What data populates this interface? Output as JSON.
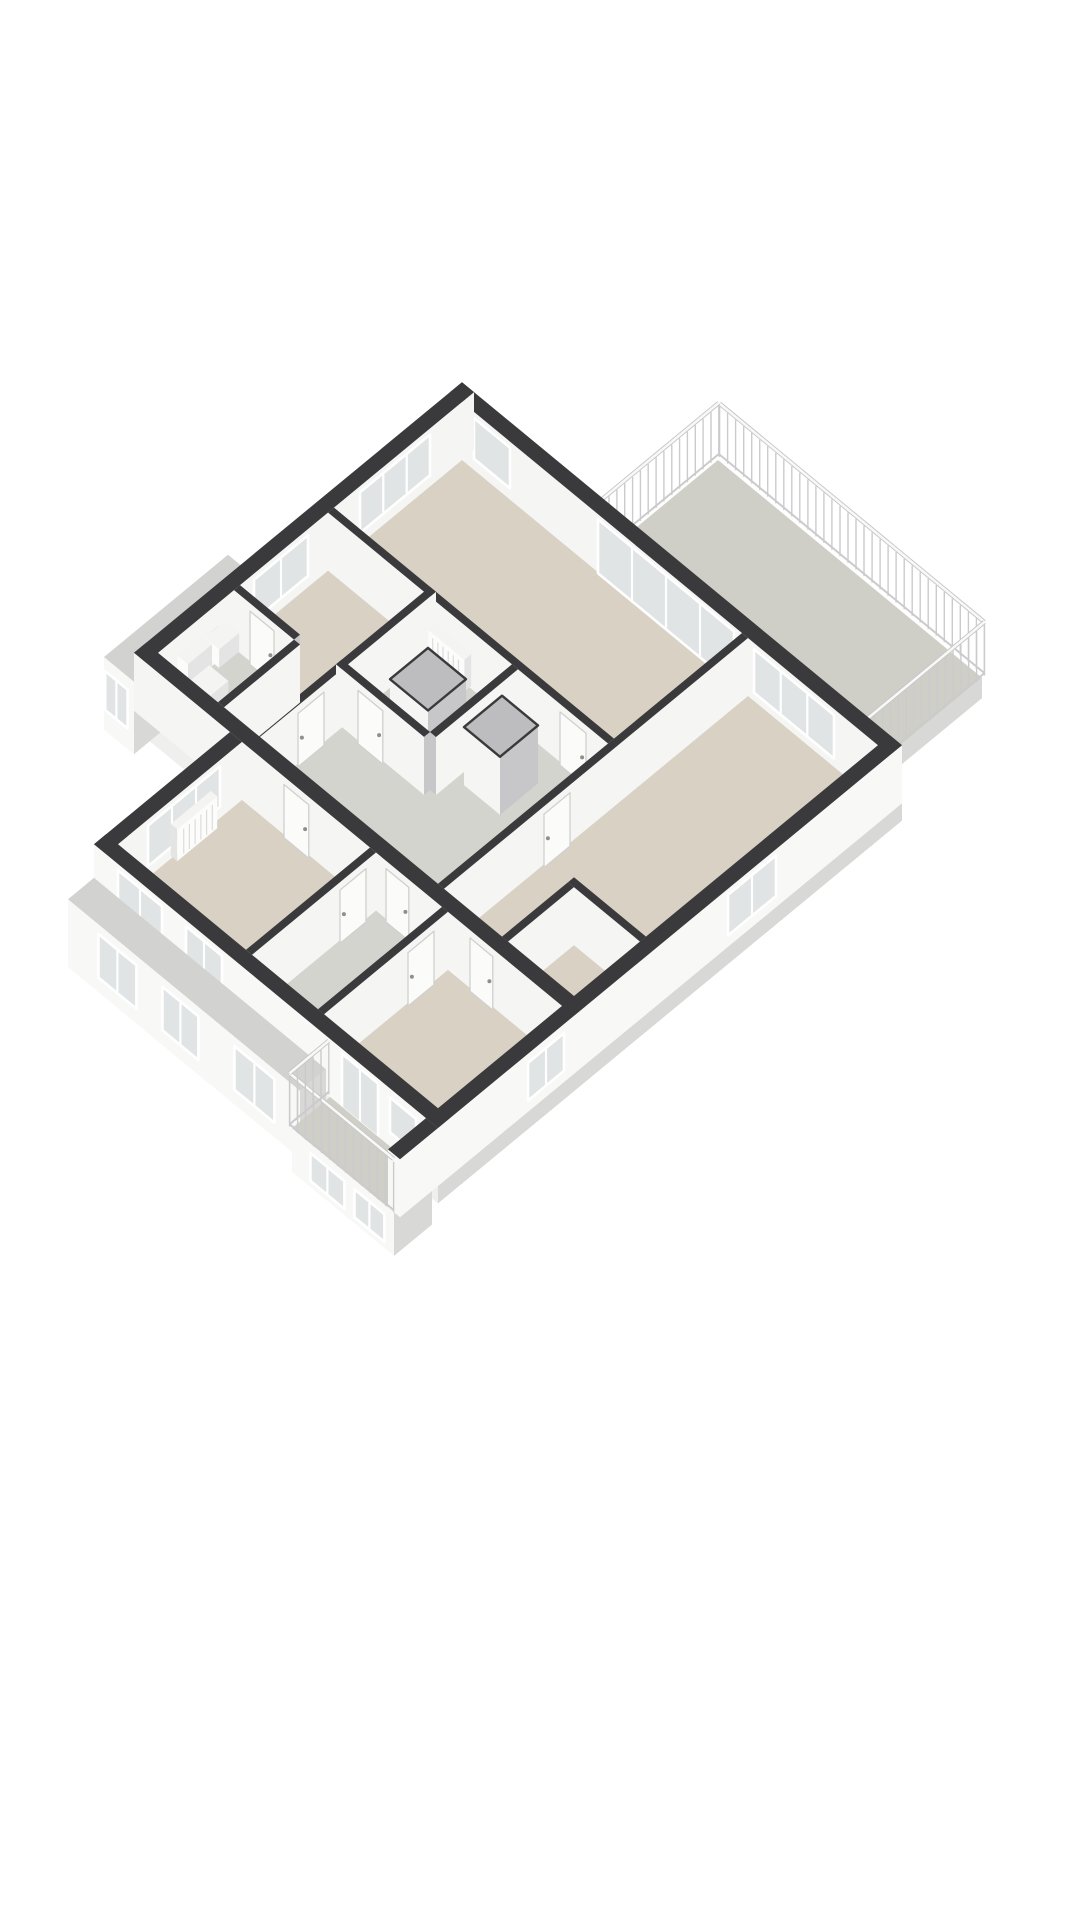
{
  "canvas": {
    "width": 1080,
    "height": 1920
  },
  "figure": {
    "kind": "isometric-3d-floorplan-render"
  },
  "palette": {
    "background": "#ffffff",
    "capDark": "#3a3a3c",
    "extX": "#ececee",
    "extY": "#f8f8f7",
    "intX": "#c7c7c9",
    "intY": "#f5f5f4",
    "slabTop": "#e6e6e4",
    "slabSide": "#d8d8d6",
    "slabFace": "#efefed",
    "bayTop": "#d2d2d0",
    "terraceFloor": "#cfcfc7",
    "floorBeige": "#d9d2c4",
    "floorGray": "#d4d4cf",
    "glass": "#e0e4e4",
    "frame": "#ffffff",
    "doorFill": "#fbfbfa",
    "doorEdge": "#d0d0d0",
    "railPost": "#cbcbcd",
    "ductTop": "#bdbdbf",
    "fixTop": "#f4f4f3",
    "fixSide": "#e4e4e5",
    "fixFace": "#fcfcfb"
  },
  "projection": {
    "cx": 462,
    "cy": 460,
    "ux": 40,
    "uy": 33,
    "uz": 58
  },
  "scene": [
    {
      "t": "box",
      "n": "terrace-slab",
      "x1": 3.2,
      "y1": -3.2,
      "x2": 9.8,
      "y2": -0.3,
      "z0": -0.35,
      "z1": 0,
      "top": "terraceFloor",
      "fx": "slabSide",
      "fy": "slabFace"
    },
    {
      "t": "rail",
      "n": "terrace-railing-back",
      "x1": 3.2,
      "y1": -3.24,
      "x2": 9.82,
      "y2": -3.24,
      "h": 0.95
    },
    {
      "t": "rail",
      "n": "terrace-railing-left",
      "x1": 3.18,
      "y1": -3.24,
      "x2": 3.18,
      "y2": -0.3,
      "h": 0.95
    },
    {
      "t": "rail",
      "n": "terrace-railing-right",
      "x1": 9.82,
      "y1": -3.24,
      "x2": 9.82,
      "y2": -0.3,
      "h": 0.95
    },
    {
      "t": "box",
      "n": "apartment-slab",
      "x1": -0.3,
      "y1": -0.3,
      "x2": 10.7,
      "y2": 7.9,
      "z0": -0.3,
      "z1": 0,
      "top": "slabTop",
      "fx": "slabSide",
      "fy": "slabFace"
    },
    {
      "t": "box",
      "n": "lower-slab",
      "x1": 2.1,
      "y1": 7.9,
      "x2": 10.7,
      "y2": 11.3,
      "z0": -0.3,
      "z1": 0,
      "top": "slabTop",
      "fx": "slabSide",
      "fy": "slabFace"
    },
    {
      "t": "box",
      "n": "side-bay",
      "x1": -1.05,
      "y1": 4.8,
      "x2": -0.3,
      "y2": 7.9,
      "z0": -0.75,
      "z1": 0.5,
      "top": "bayTop",
      "fx": "slabSide",
      "fy": "extY"
    },
    {
      "t": "panel",
      "n": "bay-window",
      "plane": "y",
      "c": 7.9,
      "off": 0.04,
      "u1": -0.98,
      "u2": -0.42,
      "z1": -0.35,
      "z2": 0.32,
      "fill": "glass",
      "mull": 2
    },
    {
      "t": "floor",
      "n": "living-room-floor",
      "pts": [
        [
          0,
          0
        ],
        [
          7.0,
          0
        ],
        [
          7.0,
          3.2
        ],
        [
          0,
          3.2
        ]
      ],
      "fill": "floorBeige"
    },
    {
      "t": "floor",
      "n": "master-bedroom-floor",
      "pts": [
        [
          7.15,
          0
        ],
        [
          10.4,
          0
        ],
        [
          10.4,
          7.6
        ],
        [
          7.15,
          7.6
        ]
      ],
      "fill": "floorBeige"
    },
    {
      "t": "floor",
      "n": "left-room-floor",
      "pts": [
        [
          0,
          3.35
        ],
        [
          2.4,
          3.35
        ],
        [
          2.4,
          7.6
        ],
        [
          0,
          7.6
        ]
      ],
      "fill": "floorBeige"
    },
    {
      "t": "floor",
      "n": "wc-floor",
      "pts": [
        [
          0,
          5.7
        ],
        [
          1.5,
          5.7
        ],
        [
          1.5,
          7.6
        ],
        [
          0,
          7.6
        ]
      ],
      "fill": "floorGray"
    },
    {
      "t": "floor",
      "n": "hall-floor",
      "pts": [
        [
          2.55,
          3.35
        ],
        [
          7.0,
          3.35
        ],
        [
          7.0,
          7.6
        ],
        [
          2.55,
          7.6
        ]
      ],
      "fill": "floorGray"
    },
    {
      "t": "floor",
      "n": "bathroom-floor",
      "pts": [
        [
          2.55,
          3.35
        ],
        [
          4.6,
          3.35
        ],
        [
          4.6,
          5.4
        ],
        [
          2.55,
          5.4
        ]
      ],
      "fill": "floorGray"
    },
    {
      "t": "floor",
      "n": "bedroom2-floor",
      "pts": [
        [
          2.4,
          7.9
        ],
        [
          5.6,
          7.9
        ],
        [
          5.6,
          11.0
        ],
        [
          2.4,
          11.0
        ]
      ],
      "fill": "floorBeige"
    },
    {
      "t": "floor",
      "n": "bathroom2-floor",
      "pts": [
        [
          5.75,
          7.9
        ],
        [
          7.4,
          7.9
        ],
        [
          7.4,
          11.0
        ],
        [
          5.75,
          11.0
        ]
      ],
      "fill": "floorGray"
    },
    {
      "t": "floor",
      "n": "bedroom3-floor",
      "pts": [
        [
          7.55,
          7.9
        ],
        [
          10.4,
          7.9
        ],
        [
          10.4,
          11.0
        ],
        [
          7.55,
          11.0
        ]
      ],
      "fill": "floorBeige"
    },
    {
      "t": "box",
      "n": "north-wall",
      "x1": -0.3,
      "y1": -0.3,
      "x2": 10.7,
      "y2": 0,
      "z0": 0,
      "z1": 1,
      "top": "capDark",
      "fx": "extX",
      "fy": "intY"
    },
    {
      "t": "panel",
      "n": "corner-window",
      "plane": "y",
      "c": 0,
      "off": 0.05,
      "u1": 0.35,
      "u2": 1.25,
      "z1": 0.25,
      "z2": 0.95,
      "fill": "glass"
    },
    {
      "t": "panel",
      "n": "terrace-glass-doors",
      "plane": "y",
      "c": 0,
      "off": 0.05,
      "u1": 3.45,
      "u2": 6.85,
      "z1": 0.04,
      "z2": 0.97,
      "fill": "glass",
      "mull": 4
    },
    {
      "t": "panel",
      "n": "master-window-band",
      "plane": "y",
      "c": 0,
      "off": 0.05,
      "u1": 7.35,
      "u2": 9.35,
      "z1": 0.2,
      "z2": 0.95,
      "fill": "glass",
      "mull": 3
    },
    {
      "t": "box",
      "n": "west-wall",
      "x1": -0.3,
      "y1": -0.3,
      "x2": 0,
      "y2": 7.9,
      "z0": 0,
      "z1": 1,
      "top": "capDark",
      "fx": "intY",
      "fy": "extY"
    },
    {
      "t": "panel",
      "n": "living-window",
      "plane": "x",
      "c": 0,
      "off": 0.05,
      "u1": 0.85,
      "u2": 2.6,
      "z1": 0.25,
      "z2": 0.95,
      "fill": "glass",
      "mull": 3
    },
    {
      "t": "panel",
      "n": "left-room-window",
      "plane": "x",
      "c": 0,
      "off": 0.05,
      "u1": 3.9,
      "u2": 5.25,
      "z1": 0.25,
      "z2": 0.95,
      "fill": "glass",
      "mull": 2
    },
    {
      "t": "panel",
      "n": "wall-socket",
      "plane": "x",
      "c": 0,
      "off": 0.05,
      "u1": 6.15,
      "u2": 6.32,
      "z1": 0.5,
      "z2": 0.66,
      "fill": "#d9d9d8",
      "frame": false
    },
    {
      "t": "box",
      "n": "living-hall-wall",
      "x1": 0,
      "y1": 3.2,
      "x2": 7.0,
      "y2": 3.35,
      "z0": 0,
      "z1": 1,
      "top": "capDark",
      "fx": "intX",
      "fy": "intY"
    },
    {
      "t": "door",
      "n": "hall-door-1",
      "plane": "y",
      "c": 3.35,
      "off": 0.05,
      "u1": 5.85,
      "u2": 6.5,
      "z1": 0,
      "z2": 0.92
    },
    {
      "t": "box",
      "n": "left-room-wall",
      "x1": 2.4,
      "y1": 3.2,
      "x2": 2.55,
      "y2": 7.6,
      "z0": 0,
      "z1": 1,
      "top": "capDark",
      "fx": "intY",
      "fy": "intX"
    },
    {
      "t": "door",
      "n": "left-room-door",
      "plane": "x",
      "c": 2.55,
      "off": 0.05,
      "u1": 6.05,
      "u2": 6.7,
      "z1": 0,
      "z2": 0.92
    },
    {
      "t": "box",
      "n": "wc-front-wall",
      "x1": 0,
      "y1": 5.55,
      "x2": 1.5,
      "y2": 5.7,
      "z0": 0,
      "z1": 1,
      "top": "capDark",
      "fx": "intX",
      "fy": "intY"
    },
    {
      "t": "door",
      "n": "wc-door",
      "plane": "y",
      "c": 5.7,
      "off": 0.05,
      "u1": 0.45,
      "u2": 1.05,
      "z1": 0,
      "z2": 0.92
    },
    {
      "t": "box",
      "n": "sink",
      "x1": 0.02,
      "y1": 5.95,
      "x2": 0.38,
      "y2": 6.45,
      "z0": 0.3,
      "z1": 0.62,
      "top": "fixTop",
      "fx": "fixSide",
      "fy": "fixFace"
    },
    {
      "t": "box",
      "n": "radiator",
      "x1": 2.7,
      "y1": 3.37,
      "x2": 3.6,
      "y2": 3.54,
      "z0": 0.07,
      "z1": 0.62,
      "top": "fixTop",
      "fx": "fixSide",
      "fy": "fixFace",
      "slats": 6
    },
    {
      "t": "box",
      "n": "toilet-cistern",
      "x1": 0.04,
      "y1": 6.55,
      "x2": 0.3,
      "y2": 7.15,
      "z0": 0.22,
      "z1": 0.72,
      "top": "fixTop",
      "fx": "fixSide",
      "fy": "fixFace"
    },
    {
      "t": "box",
      "n": "toilet-bowl",
      "x1": 0.3,
      "y1": 6.62,
      "x2": 0.78,
      "y2": 7.08,
      "z0": 0,
      "z1": 0.4,
      "top": "fixTop",
      "fx": "fixSide",
      "fy": "fixFace"
    },
    {
      "t": "box",
      "n": "master-wall",
      "x1": 7.0,
      "y1": 0,
      "x2": 7.15,
      "y2": 7.6,
      "z0": 0,
      "z1": 1,
      "top": "capDark",
      "fx": "intY",
      "fy": "intX"
    },
    {
      "t": "door",
      "n": "master-door",
      "plane": "x",
      "c": 7.15,
      "off": 0.05,
      "u1": 4.5,
      "u2": 5.15,
      "z1": 0,
      "z2": 0.92
    },
    {
      "t": "box",
      "n": "wc-side-wall",
      "x1": 1.5,
      "y1": 5.7,
      "x2": 1.65,
      "y2": 7.6,
      "z0": 0,
      "z1": 1,
      "top": "capDark",
      "fx": "intY",
      "fy": "intX"
    },
    {
      "t": "box",
      "n": "duct-1",
      "x1": 3.3,
      "y1": 4.15,
      "x2": 4.25,
      "y2": 5.1,
      "z0": 0,
      "z1": 1,
      "top": "ductTop",
      "fx": "intX",
      "fy": "intY",
      "rim": true
    },
    {
      "t": "box",
      "n": "bath-front-wall",
      "x1": 2.4,
      "y1": 5.4,
      "x2": 4.6,
      "y2": 5.55,
      "z0": 0,
      "z1": 1,
      "top": "capDark",
      "fx": "intX",
      "fy": "intY"
    },
    {
      "t": "door",
      "n": "bath-door",
      "plane": "y",
      "c": 5.55,
      "off": 0.05,
      "u1": 3.0,
      "u2": 3.62,
      "z1": 0,
      "z2": 0.92
    },
    {
      "t": "box",
      "n": "bath-side-wall",
      "x1": 4.6,
      "y1": 3.35,
      "x2": 4.75,
      "y2": 5.4,
      "z0": 0,
      "z1": 1,
      "top": "capDark",
      "fx": "intY",
      "fy": "intX"
    },
    {
      "t": "box",
      "n": "duct-2",
      "x1": 4.95,
      "y1": 3.95,
      "x2": 5.85,
      "y2": 4.9,
      "z0": 0,
      "z1": 1,
      "top": "ductTop",
      "fx": "intX",
      "fy": "intY",
      "rim": true
    },
    {
      "t": "box",
      "n": "closet-front-wall",
      "x1": 8.6,
      "y1": 5.8,
      "x2": 10.4,
      "y2": 5.95,
      "z0": 0,
      "z1": 1,
      "top": "capDark",
      "fx": "intX",
      "fy": "intY"
    },
    {
      "t": "box",
      "n": "closet-side-wall",
      "x1": 8.6,
      "y1": 5.95,
      "x2": 8.75,
      "y2": 7.6,
      "z0": 0,
      "z1": 1,
      "top": "capDark",
      "fx": "intY",
      "fy": "intX"
    },
    {
      "t": "box",
      "n": "mid-wall",
      "x1": -0.3,
      "y1": 7.6,
      "x2": 10.7,
      "y2": 7.9,
      "z0": 0,
      "z1": 1,
      "top": "capDark",
      "fx": "extX",
      "fy": "intY"
    },
    {
      "t": "door",
      "n": "bedroom2-door",
      "plane": "y",
      "c": 7.9,
      "off": 0.05,
      "u1": 3.5,
      "u2": 4.12,
      "z1": 0,
      "z2": 0.92
    },
    {
      "t": "door",
      "n": "bathroom2-door",
      "plane": "y",
      "c": 7.9,
      "off": 0.05,
      "u1": 6.05,
      "u2": 6.62,
      "z1": 0,
      "z2": 0.92
    },
    {
      "t": "door",
      "n": "bedroom3-door",
      "plane": "y",
      "c": 7.9,
      "off": 0.05,
      "u1": 8.15,
      "u2": 8.72,
      "z1": 0,
      "z2": 0.92
    },
    {
      "t": "box",
      "n": "lower-west-wall",
      "x1": 2.1,
      "y1": 7.9,
      "x2": 2.4,
      "y2": 11.3,
      "z0": 0,
      "z1": 1,
      "top": "capDark",
      "fx": "intY",
      "fy": "extY"
    },
    {
      "t": "panel",
      "n": "bedroom2-window",
      "plane": "x",
      "c": 2.4,
      "off": 0.05,
      "u1": 8.5,
      "u2": 10.3,
      "z1": 0.25,
      "z2": 0.95,
      "fill": "glass",
      "mull": 3
    },
    {
      "t": "box",
      "n": "radiator-2",
      "x1": 2.42,
      "y1": 8.7,
      "x2": 2.58,
      "y2": 9.7,
      "z0": 0.07,
      "z1": 0.62,
      "top": "fixTop",
      "fx": "fixFace",
      "fy": "fixSide",
      "slatsX": 6
    },
    {
      "t": "box",
      "n": "lower-mid-wall-1",
      "x1": 5.6,
      "y1": 7.9,
      "x2": 5.75,
      "y2": 11.0,
      "z0": 0,
      "z1": 1,
      "top": "capDark",
      "fx": "intY",
      "fy": "intX"
    },
    {
      "t": "door",
      "n": "bathroom2-inner-door",
      "plane": "x",
      "c": 5.75,
      "off": 0.05,
      "u1": 8.2,
      "u2": 8.85,
      "z1": 0,
      "z2": 0.92
    },
    {
      "t": "box",
      "n": "lower-mid-wall-2",
      "x1": 7.4,
      "y1": 7.9,
      "x2": 7.55,
      "y2": 11.0,
      "z0": 0,
      "z1": 1,
      "top": "capDark",
      "fx": "intY",
      "fy": "intX"
    },
    {
      "t": "door",
      "n": "bedroom3-inner-door",
      "plane": "x",
      "c": 7.55,
      "off": 0.05,
      "u1": 8.3,
      "u2": 8.95,
      "z1": 0,
      "z2": 0.92
    },
    {
      "t": "box",
      "n": "south-wall",
      "x1": 2.1,
      "y1": 11.0,
      "x2": 10.7,
      "y2": 11.3,
      "z0": 0,
      "z1": 1,
      "top": "capDark",
      "fx": "extX",
      "fy": "extY"
    },
    {
      "t": "panel",
      "n": "south-window-1",
      "plane": "y",
      "c": 11.3,
      "off": 0.05,
      "u1": 2.75,
      "u2": 3.85,
      "z1": 0.25,
      "z2": 0.95,
      "fill": "glass",
      "mull": 2
    },
    {
      "t": "panel",
      "n": "south-window-2",
      "plane": "y",
      "c": 11.3,
      "off": 0.05,
      "u1": 4.45,
      "u2": 5.35,
      "z1": 0.3,
      "z2": 0.95,
      "fill": "glass",
      "mull": 2
    },
    {
      "t": "panel",
      "n": "balcony-glass-door",
      "plane": "y",
      "c": 11.3,
      "off": 0.05,
      "u1": 8.35,
      "u2": 9.25,
      "z1": 0.04,
      "z2": 0.97,
      "fill": "glass",
      "mull": 2
    },
    {
      "t": "panel",
      "n": "south-window-3",
      "plane": "y",
      "c": 11.3,
      "off": 0.05,
      "u1": 9.55,
      "u2": 10.2,
      "z1": 0.3,
      "z2": 0.9,
      "fill": "glass"
    },
    {
      "t": "box",
      "n": "south-ledge",
      "x1": 2.1,
      "y1": 11.3,
      "x2": 7.9,
      "y2": 11.95,
      "z0": -0.75,
      "z1": 0.42,
      "top": "bayTop",
      "fx": "slabSide",
      "fy": "extY"
    },
    {
      "t": "panel",
      "n": "ledge-window-1",
      "plane": "y",
      "c": 11.95,
      "off": 0.04,
      "u1": 2.9,
      "u2": 3.85,
      "z1": -0.45,
      "z2": 0.3,
      "fill": "glass",
      "mull": 2
    },
    {
      "t": "panel",
      "n": "ledge-window-2",
      "plane": "y",
      "c": 11.95,
      "off": 0.04,
      "u1": 4.5,
      "u2": 5.4,
      "z1": -0.45,
      "z2": 0.3,
      "fill": "glass",
      "mull": 2
    },
    {
      "t": "panel",
      "n": "ledge-window-3",
      "plane": "y",
      "c": 11.95,
      "off": 0.04,
      "u1": 6.3,
      "u2": 7.3,
      "z1": -0.45,
      "z2": 0.3,
      "fill": "glass",
      "mull": 2
    },
    {
      "t": "box",
      "n": "balcony-slab",
      "x1": 8.0,
      "y1": 11.3,
      "x2": 10.55,
      "y2": 12.25,
      "z0": -0.75,
      "z1": 0,
      "top": "terraceFloor",
      "fx": "slabSide",
      "fy": "extY"
    },
    {
      "t": "panel",
      "n": "under-balcony-window-1",
      "plane": "y",
      "c": 12.25,
      "off": 0.04,
      "u1": 8.5,
      "u2": 9.35,
      "z1": -0.6,
      "z2": -0.12,
      "fill": "glass",
      "mull": 2
    },
    {
      "t": "panel",
      "n": "under-balcony-window-2",
      "plane": "y",
      "c": 12.25,
      "off": 0.04,
      "u1": 9.6,
      "u2": 10.35,
      "z1": -0.6,
      "z2": -0.12,
      "fill": "glass",
      "mull": 2
    },
    {
      "t": "box",
      "n": "east-wall",
      "x1": 10.4,
      "y1": -0.3,
      "x2": 10.7,
      "y2": 11.3,
      "z0": 0,
      "z1": 1,
      "top": "capDark",
      "fx": "extY",
      "fy": "extY"
    },
    {
      "t": "panel",
      "n": "east-window-1",
      "plane": "x",
      "c": 10.7,
      "off": 0.05,
      "u1": 2.9,
      "u2": 4.1,
      "z1": 0.25,
      "z2": 0.95,
      "fill": "glass",
      "mull": 2
    },
    {
      "t": "panel",
      "n": "east-window-2",
      "plane": "x",
      "c": 10.7,
      "off": 0.05,
      "u1": 8.2,
      "u2": 9.1,
      "z1": 0.25,
      "z2": 0.9,
      "fill": "glass",
      "mull": 2
    },
    {
      "t": "box",
      "n": "balcony-side-wall",
      "x1": 10.4,
      "y1": 11.3,
      "x2": 10.7,
      "y2": 12.25,
      "z0": 0,
      "z1": 1,
      "top": "capDark",
      "fx": "extY",
      "fy": "extY"
    },
    {
      "t": "rail",
      "n": "balcony-railing-front",
      "x1": 7.97,
      "y1": 12.28,
      "x2": 10.57,
      "y2": 12.28,
      "h": 0.95
    },
    {
      "t": "rail",
      "n": "balcony-railing-left",
      "x1": 7.97,
      "y1": 11.3,
      "x2": 7.97,
      "y2": 12.28,
      "h": 0.95
    }
  ]
}
